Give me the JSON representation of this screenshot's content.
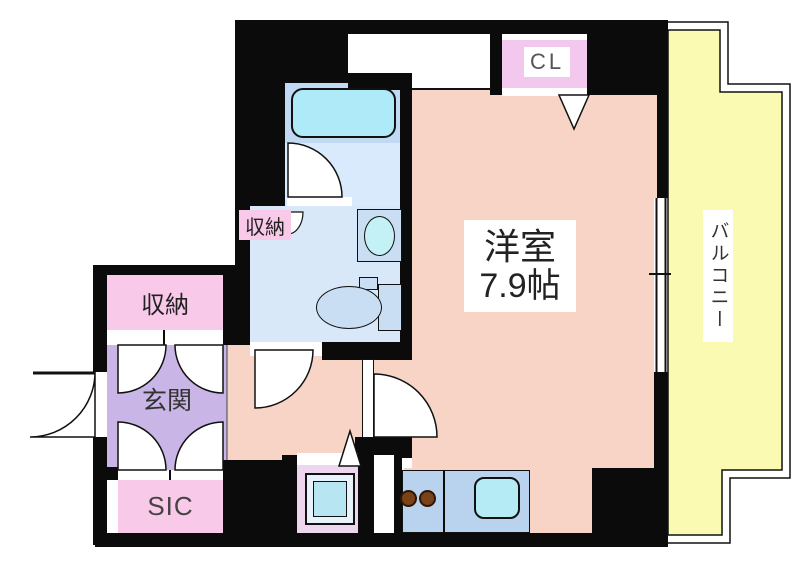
{
  "page": {
    "type": "floor-plan",
    "description": "Japanese apartment floor plan"
  },
  "labels": {
    "main_room_name": "洋室",
    "main_room_size": "7.9帖",
    "balcony": "バルコニー",
    "entrance": "玄関",
    "closet": "CL",
    "storage_entry": "収納",
    "storage_washroom": "収納",
    "shoe_closet": "SIC"
  },
  "fixtures": [
    "bathtub",
    "washbasin",
    "toilet",
    "washing-machine",
    "gas-stove-burners",
    "kitchen-sink",
    "swing-doors",
    "folding-doors",
    "window"
  ],
  "colors": {
    "wall": "#0b0b0b",
    "room_salmon": "#f8d4c6",
    "entrance_purple": "#c9b5e6",
    "closet_pink": "#f8c9e9",
    "cl_pink": "#f3c8ee",
    "balcony_yellow": "#fbfab2",
    "washroom_blue": "#d9e8f8",
    "bath_blue": "#c2d9f3",
    "tub_cyan": "#aeeaf8",
    "kitchen_blue": "#b9d3ee",
    "sink_cyan": "#b5ebf5",
    "burner_brown": "#7a4218"
  }
}
